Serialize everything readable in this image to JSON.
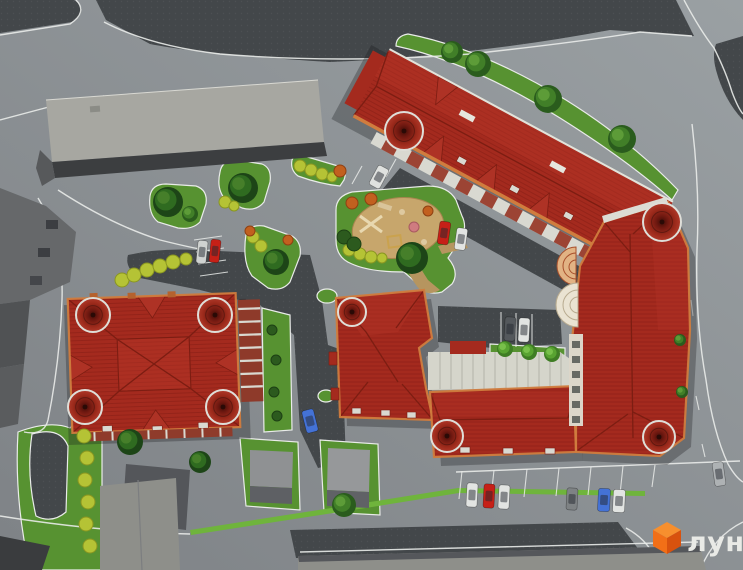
{
  "meta": {
    "description": "Aerial 3D architectural render of a residential complex master plan with three red-roofed buildings, courtyard playground, parking and surrounding streets",
    "width": 743,
    "height": 570
  },
  "logo": {
    "text": "лун",
    "icon": "orange-cube-icon"
  },
  "palette": {
    "road_top": "#9aa0a3",
    "road_bottom": "#7e8286",
    "dark_pavement": "#43474a",
    "curb": "#e9ebe9",
    "grass": "#579231",
    "grass_light": "#6fb43c",
    "sand": "#c7a66c",
    "sand_path": "#b6955f",
    "roof": "#a42a1e",
    "roof_light": "#b53527",
    "roof_dark": "#7c1d12",
    "trim": "#d07c3e",
    "facade_white": "#d9d9d1",
    "facade_brick": "#8e3a2a",
    "gray_roof": "#a7a7a1",
    "gray_mid": "#8e8f8a",
    "gray_side": "#3c3e40",
    "shadow": "rgba(22,24,28,0.30)",
    "logo_orange": "#f26f17",
    "logo_text": "#e9eae6"
  },
  "scene": {
    "cars": [
      {
        "color": "#c62017",
        "cx": 215,
        "cy": 251,
        "w": 10,
        "h": 23,
        "angle": 6
      },
      {
        "color": "#cfd2d0",
        "cx": 202,
        "cy": 252,
        "w": 10,
        "h": 23,
        "angle": 6
      },
      {
        "color": "#dfe1df",
        "cx": 379,
        "cy": 177,
        "w": 12,
        "h": 22,
        "angle": 28
      },
      {
        "color": "#c62017",
        "cx": 444,
        "cy": 233,
        "w": 11,
        "h": 23,
        "angle": 8
      },
      {
        "color": "#e2e4e2",
        "cx": 461,
        "cy": 239,
        "w": 11,
        "h": 22,
        "angle": 8
      },
      {
        "color": "#54585c",
        "cx": 510,
        "cy": 329,
        "w": 11,
        "h": 24,
        "angle": 3
      },
      {
        "color": "#e2e4e2",
        "cx": 524,
        "cy": 330,
        "w": 11,
        "h": 24,
        "angle": 3
      },
      {
        "color": "#4472d6",
        "cx": 310,
        "cy": 421,
        "w": 12,
        "h": 23,
        "angle": -14
      },
      {
        "color": "#e2e4e2",
        "cx": 472,
        "cy": 495,
        "w": 11,
        "h": 24,
        "angle": 3
      },
      {
        "color": "#c62017",
        "cx": 489,
        "cy": 496,
        "w": 11,
        "h": 24,
        "angle": 3
      },
      {
        "color": "#e2e4e2",
        "cx": 504,
        "cy": 497,
        "w": 11,
        "h": 24,
        "angle": 3
      },
      {
        "color": "#7e8284",
        "cx": 572,
        "cy": 499,
        "w": 11,
        "h": 22,
        "angle": 3
      },
      {
        "color": "#4472d6",
        "cx": 604,
        "cy": 500,
        "w": 12,
        "h": 23,
        "angle": 3
      },
      {
        "color": "#e2e4e2",
        "cx": 619,
        "cy": 501,
        "w": 12,
        "h": 23,
        "angle": 3
      },
      {
        "color": "#aeb2b4",
        "cx": 719,
        "cy": 474,
        "w": 11,
        "h": 24,
        "angle": -8
      }
    ],
    "trees": [
      {
        "x": 168,
        "y": 202,
        "r": 15,
        "t": "dark"
      },
      {
        "x": 243,
        "y": 188,
        "r": 15,
        "t": "dark"
      },
      {
        "x": 276,
        "y": 262,
        "r": 13,
        "t": "dark"
      },
      {
        "x": 412,
        "y": 258,
        "r": 16,
        "t": "dark"
      },
      {
        "x": 452,
        "y": 52,
        "r": 11,
        "t": "mid"
      },
      {
        "x": 478,
        "y": 64,
        "r": 13,
        "t": "mid"
      },
      {
        "x": 548,
        "y": 99,
        "r": 14,
        "t": "mid"
      },
      {
        "x": 622,
        "y": 139,
        "r": 14,
        "t": "mid"
      },
      {
        "x": 130,
        "y": 442,
        "r": 13,
        "t": "dark"
      },
      {
        "x": 200,
        "y": 462,
        "r": 11,
        "t": "dark"
      },
      {
        "x": 344,
        "y": 505,
        "r": 12,
        "t": "mid"
      },
      {
        "x": 505,
        "y": 349,
        "r": 8,
        "t": "light"
      },
      {
        "x": 529,
        "y": 352,
        "r": 8,
        "t": "light"
      },
      {
        "x": 552,
        "y": 354,
        "r": 8,
        "t": "light"
      },
      {
        "x": 682,
        "y": 392,
        "r": 6,
        "t": "mid"
      },
      {
        "x": 680,
        "y": 340,
        "r": 6,
        "t": "mid"
      },
      {
        "x": 190,
        "y": 214,
        "r": 8,
        "t": "mid"
      }
    ],
    "bushes": [
      {
        "x": 122,
        "y": 280,
        "r": 7,
        "t": "yellow"
      },
      {
        "x": 134,
        "y": 275,
        "r": 7,
        "t": "yellow"
      },
      {
        "x": 147,
        "y": 270,
        "r": 7,
        "t": "yellow"
      },
      {
        "x": 160,
        "y": 266,
        "r": 7,
        "t": "yellow"
      },
      {
        "x": 173,
        "y": 262,
        "r": 7,
        "t": "yellow"
      },
      {
        "x": 186,
        "y": 259,
        "r": 6,
        "t": "yellow"
      },
      {
        "x": 84,
        "y": 436,
        "r": 7,
        "t": "yellow"
      },
      {
        "x": 87,
        "y": 458,
        "r": 7,
        "t": "yellow"
      },
      {
        "x": 85,
        "y": 480,
        "r": 7,
        "t": "yellow"
      },
      {
        "x": 88,
        "y": 502,
        "r": 7,
        "t": "yellow"
      },
      {
        "x": 86,
        "y": 524,
        "r": 7,
        "t": "yellow"
      },
      {
        "x": 90,
        "y": 546,
        "r": 7,
        "t": "yellow"
      },
      {
        "x": 349,
        "y": 250,
        "r": 6,
        "t": "yellow"
      },
      {
        "x": 360,
        "y": 254,
        "r": 6,
        "t": "yellow"
      },
      {
        "x": 371,
        "y": 257,
        "r": 6,
        "t": "yellow"
      },
      {
        "x": 382,
        "y": 258,
        "r": 5,
        "t": "yellow"
      },
      {
        "x": 300,
        "y": 166,
        "r": 6,
        "t": "yellow"
      },
      {
        "x": 311,
        "y": 170,
        "r": 6,
        "t": "yellow"
      },
      {
        "x": 322,
        "y": 174,
        "r": 6,
        "t": "yellow"
      },
      {
        "x": 332,
        "y": 177,
        "r": 5,
        "t": "yellow"
      },
      {
        "x": 253,
        "y": 237,
        "r": 6,
        "t": "yellow"
      },
      {
        "x": 261,
        "y": 246,
        "r": 6,
        "t": "yellow"
      },
      {
        "x": 225,
        "y": 202,
        "r": 6,
        "t": "yellow"
      },
      {
        "x": 234,
        "y": 206,
        "r": 5,
        "t": "yellow"
      },
      {
        "x": 344,
        "y": 237,
        "r": 7,
        "t": "dark"
      },
      {
        "x": 354,
        "y": 244,
        "r": 7,
        "t": "dark"
      },
      {
        "x": 272,
        "y": 330,
        "r": 5,
        "t": "dark"
      },
      {
        "x": 276,
        "y": 360,
        "r": 5,
        "t": "dark"
      },
      {
        "x": 274,
        "y": 392,
        "r": 5,
        "t": "dark"
      },
      {
        "x": 277,
        "y": 416,
        "r": 5,
        "t": "dark"
      },
      {
        "x": 340,
        "y": 171,
        "r": 6,
        "t": "orange"
      },
      {
        "x": 352,
        "y": 203,
        "r": 6,
        "t": "orange"
      },
      {
        "x": 371,
        "y": 199,
        "r": 6,
        "t": "orange"
      },
      {
        "x": 428,
        "y": 211,
        "r": 5,
        "t": "orange"
      },
      {
        "x": 250,
        "y": 231,
        "r": 5,
        "t": "orange"
      },
      {
        "x": 288,
        "y": 240,
        "r": 5,
        "t": "orange"
      }
    ],
    "turrets": [
      {
        "x": 404,
        "y": 131,
        "r": 19
      },
      {
        "x": 662,
        "y": 222,
        "r": 19
      },
      {
        "x": 93,
        "y": 315,
        "r": 17
      },
      {
        "x": 215,
        "y": 315,
        "r": 17
      },
      {
        "x": 85,
        "y": 407,
        "r": 17
      },
      {
        "x": 223,
        "y": 407,
        "r": 17
      },
      {
        "x": 352,
        "y": 312,
        "r": 14
      },
      {
        "x": 447,
        "y": 436,
        "r": 16
      },
      {
        "x": 659,
        "y": 437,
        "r": 16
      }
    ]
  }
}
